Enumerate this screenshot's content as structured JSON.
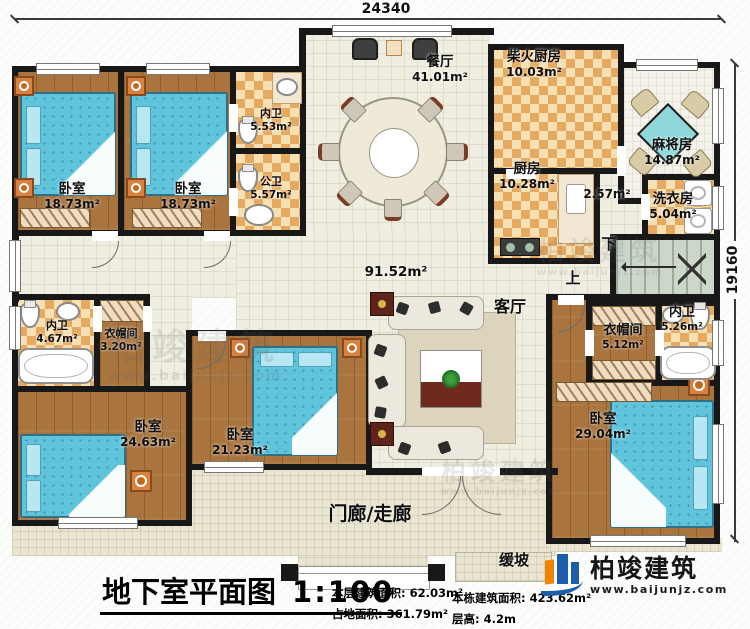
{
  "dimensions": {
    "top": "24340",
    "right": "19160"
  },
  "rooms": [
    {
      "id": "dining",
      "name": "餐厅",
      "area": "41.01m²"
    },
    {
      "id": "firewood-kitchen",
      "name": "柴火厨房",
      "area": "10.03m²"
    },
    {
      "id": "kitchen",
      "name": "厨房",
      "area": "10.28m²"
    },
    {
      "id": "mahjong-room",
      "name": "麻将房",
      "area": "14.87m²"
    },
    {
      "id": "corridor",
      "name": "",
      "area": "2.57m²"
    },
    {
      "id": "laundry",
      "name": "洗衣房",
      "area": "5.04m²"
    },
    {
      "id": "bedroom-top-1",
      "name": "卧室",
      "area": "18.73m²"
    },
    {
      "id": "bedroom-top-2",
      "name": "卧室",
      "area": "18.73m²"
    },
    {
      "id": "bath-inner-top",
      "name": "内卫",
      "area": "5.53m²"
    },
    {
      "id": "bath-public",
      "name": "公卫",
      "area": "5.57m²"
    },
    {
      "id": "living-room",
      "name": "客厅",
      "area": "91.52m²"
    },
    {
      "id": "bath-inner-left",
      "name": "内卫",
      "area": "4.67m²"
    },
    {
      "id": "closet-left",
      "name": "衣帽间",
      "area": "3.20m²"
    },
    {
      "id": "bedroom-bl",
      "name": "卧室",
      "area": "24.63m²"
    },
    {
      "id": "bedroom-bc",
      "name": "卧室",
      "area": "21.23m²"
    },
    {
      "id": "closet-right",
      "name": "衣帽间",
      "area": "5.12m²"
    },
    {
      "id": "bath-inner-right",
      "name": "内卫",
      "area": "5.26m²"
    },
    {
      "id": "bedroom-br",
      "name": "卧室",
      "area": "29.04m²"
    },
    {
      "id": "porch",
      "name": "门廊/走廊",
      "area": ""
    },
    {
      "id": "ramp",
      "name": "缓坡",
      "area": ""
    }
  ],
  "stairs": {
    "down": "下",
    "up": "上"
  },
  "footer": {
    "title": "地下室平面图",
    "scale": "1:100",
    "stats": [
      {
        "label": "本层建筑面积:",
        "value": "62.03m²"
      },
      {
        "label": "占地面积:",
        "value": "361.79m²"
      },
      {
        "label": "本栋建筑面积:",
        "value": "423.62m²"
      },
      {
        "label": "层高:",
        "value": "4.2m"
      }
    ]
  },
  "logo": {
    "name": "柏竣建筑",
    "url": "www.baijunjz.com"
  },
  "watermark": {
    "name": "柏竣建筑",
    "url": "www.baijunjz.com"
  }
}
